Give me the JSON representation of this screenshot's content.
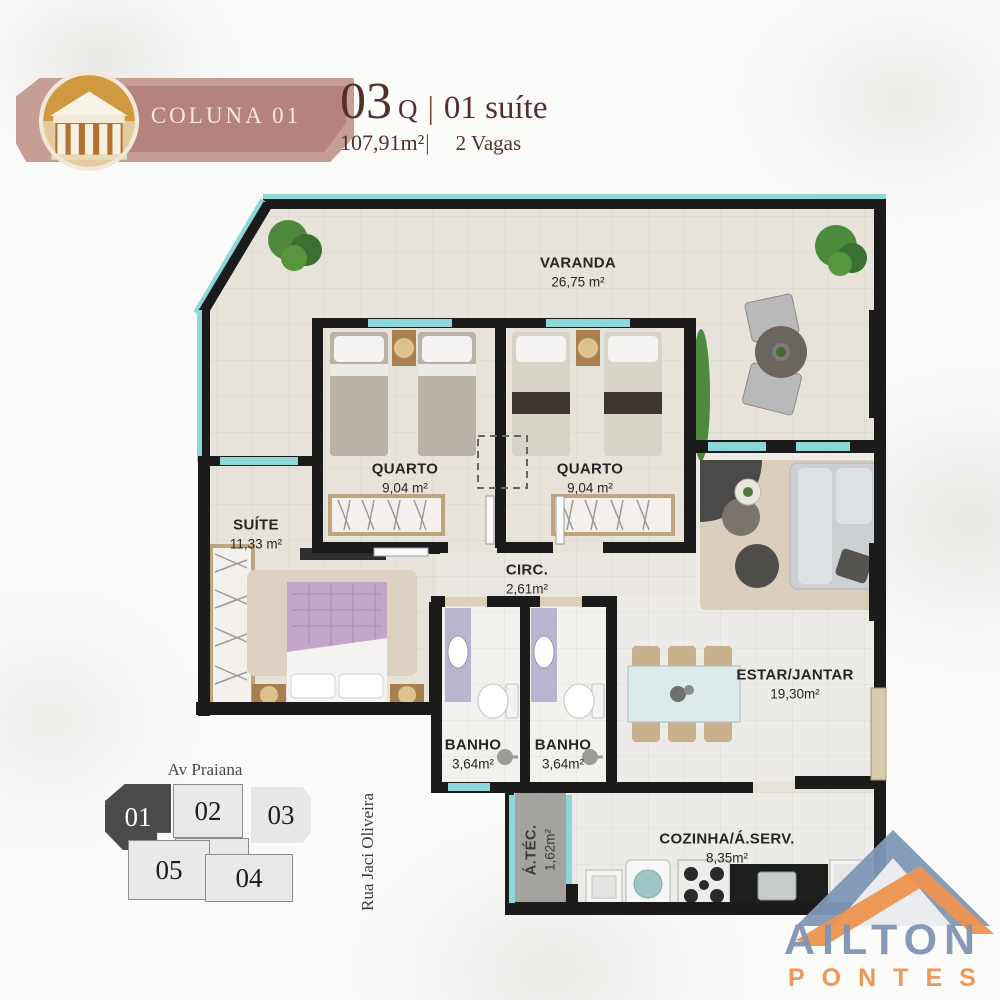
{
  "header": {
    "banner_label": "COLUNA 01",
    "bedrooms_number": "03",
    "bedrooms_suffix": "Q",
    "separator": "|",
    "suite_label": "01 suíte",
    "area_label": "107,91m²",
    "area_separator": "|",
    "parking_label": "2 Vagas",
    "banner_color": "#b4837b",
    "title_color": "#533029"
  },
  "floorplan": {
    "wall_color": "#1b1b1b",
    "floor_color": "#e7e3db",
    "window_color": "#8ed7d9",
    "rooms": [
      {
        "name": "VARANDA",
        "area": "26,75 m²"
      },
      {
        "name": "QUARTO",
        "area": "9,04 m²"
      },
      {
        "name": "QUARTO",
        "area": "9,04 m²"
      },
      {
        "name": "SUÍTE",
        "area": "11,33 m²"
      },
      {
        "name": "CIRC.",
        "area": "2,61m²"
      },
      {
        "name": "BANHO",
        "area": "3,64m²"
      },
      {
        "name": "BANHO",
        "area": "3,64m²"
      },
      {
        "name": "ESTAR/JANTAR",
        "area": "19,30m²"
      },
      {
        "name": "COZINHA/Á.SERV.",
        "area": "8,35m²"
      },
      {
        "name": "Á.TÉC.",
        "area": "1,62m²"
      }
    ]
  },
  "key_plan": {
    "street_top": "Av Praiana",
    "street_right": "Rua Jaci Oliveira",
    "units": [
      {
        "label": "01",
        "highlighted": true
      },
      {
        "label": "02",
        "highlighted": false
      },
      {
        "label": "03",
        "highlighted": false
      },
      {
        "label": "05",
        "highlighted": false
      },
      {
        "label": "04",
        "highlighted": false
      }
    ]
  },
  "watermark": {
    "line1": "AILTON",
    "line2": "PONTES",
    "blue": "#8095b4",
    "orange": "#ee9350"
  }
}
